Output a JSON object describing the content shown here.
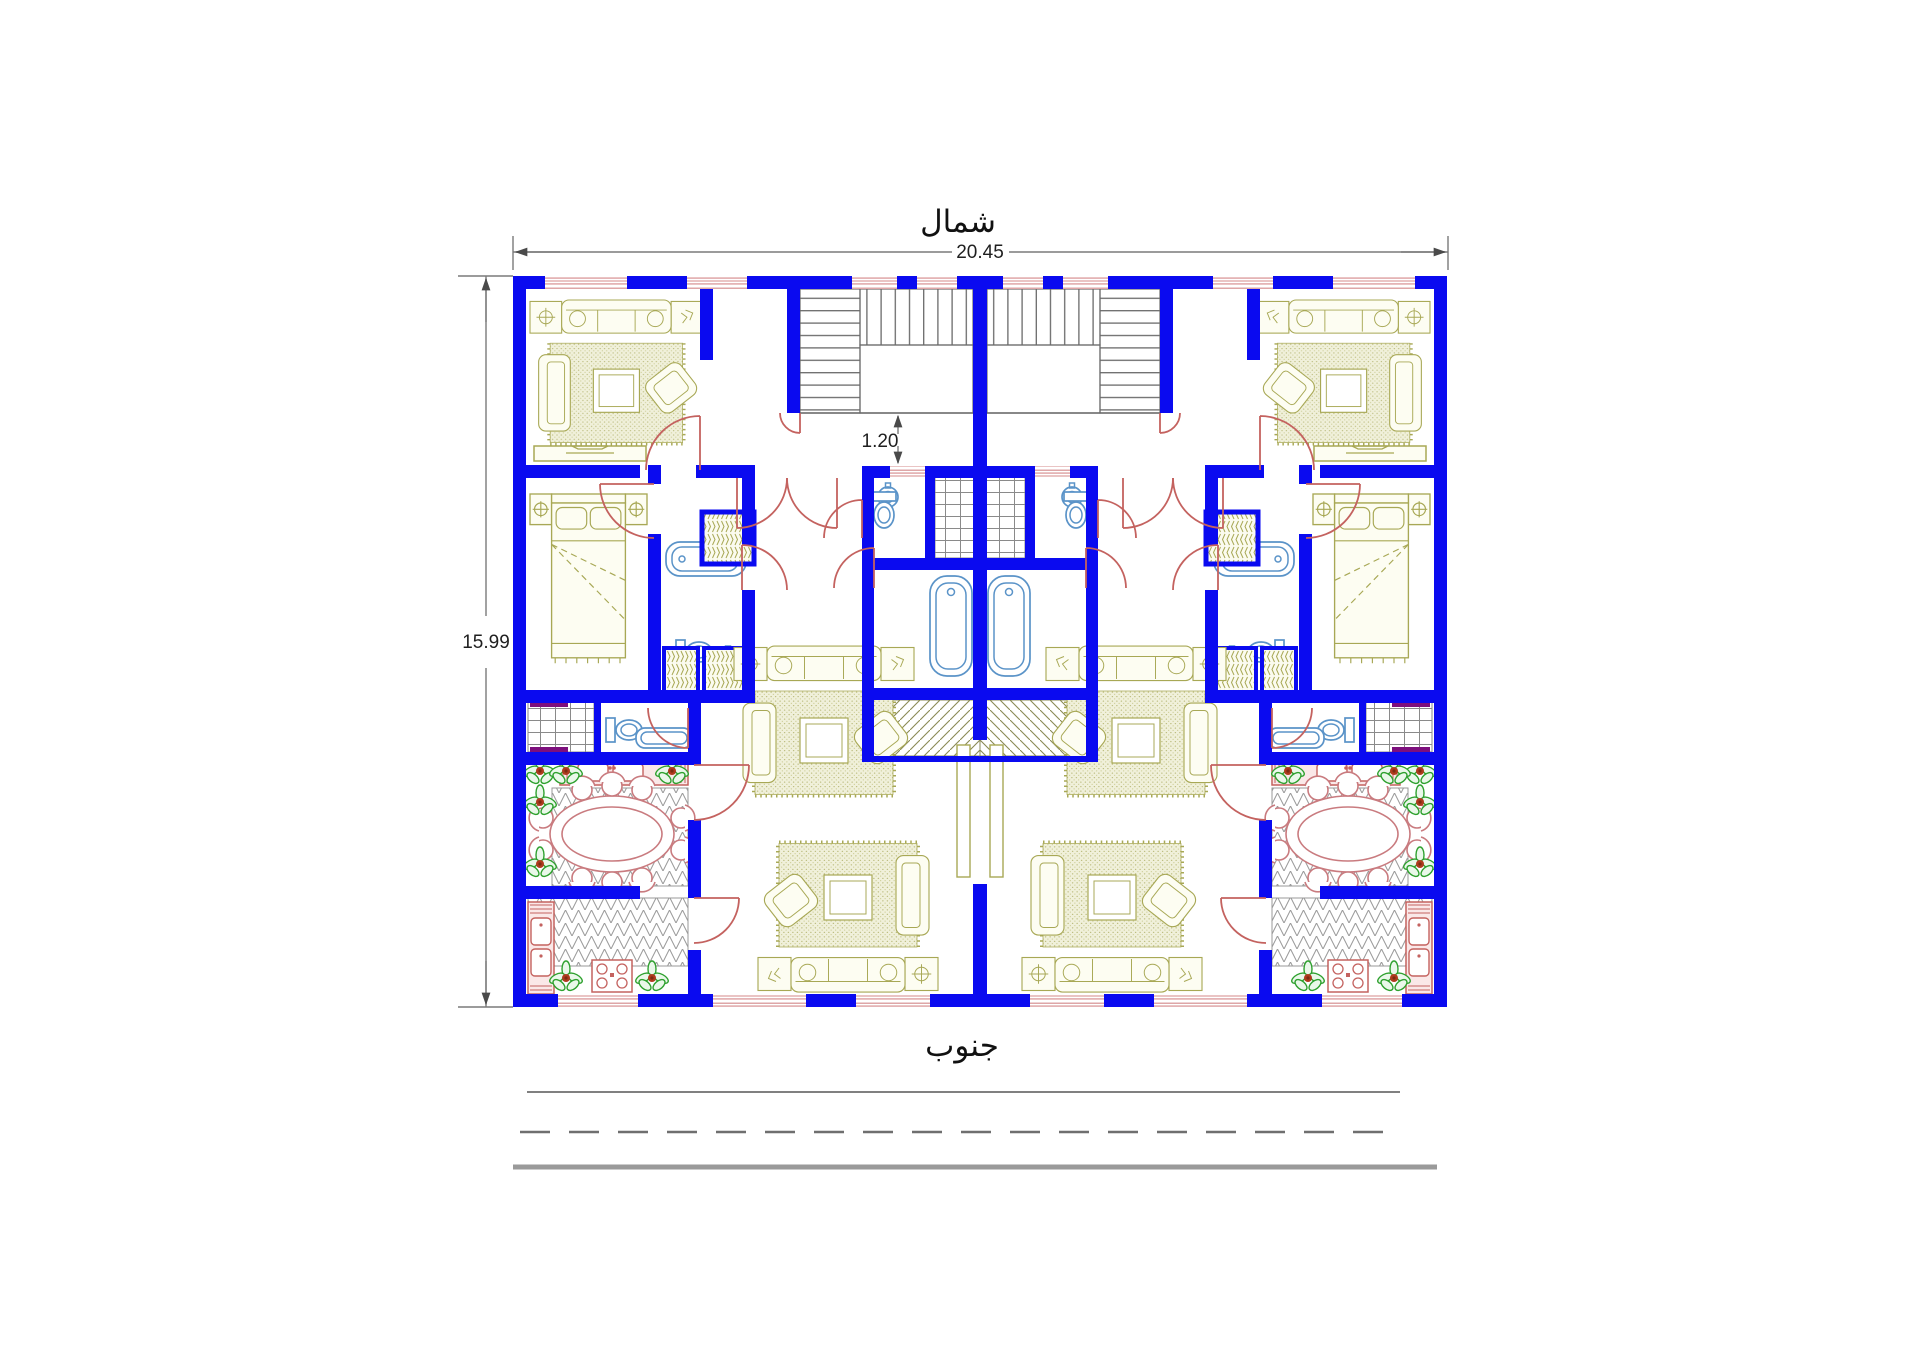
{
  "labels": {
    "north": "شمال",
    "south": "جنوب"
  },
  "dimensions": {
    "overall_width_m": "20.45",
    "overall_height_m": "15.99",
    "stair_hall_offset_m": "1.20"
  },
  "colors": {
    "wall": "#0a0af0",
    "window": "#d4888a",
    "door": "#c4625f",
    "furniture": "#a8a855",
    "fixture": "#5a93c8",
    "dining_chair": "#c97b7f",
    "counter": "#c4625f",
    "plant": "#2fa12f",
    "plant_core": "#b03a1e",
    "hatch_magenta": "#7d0f7d",
    "dimension": "#4a4a4a",
    "floor_line": "#9a9a9a"
  }
}
